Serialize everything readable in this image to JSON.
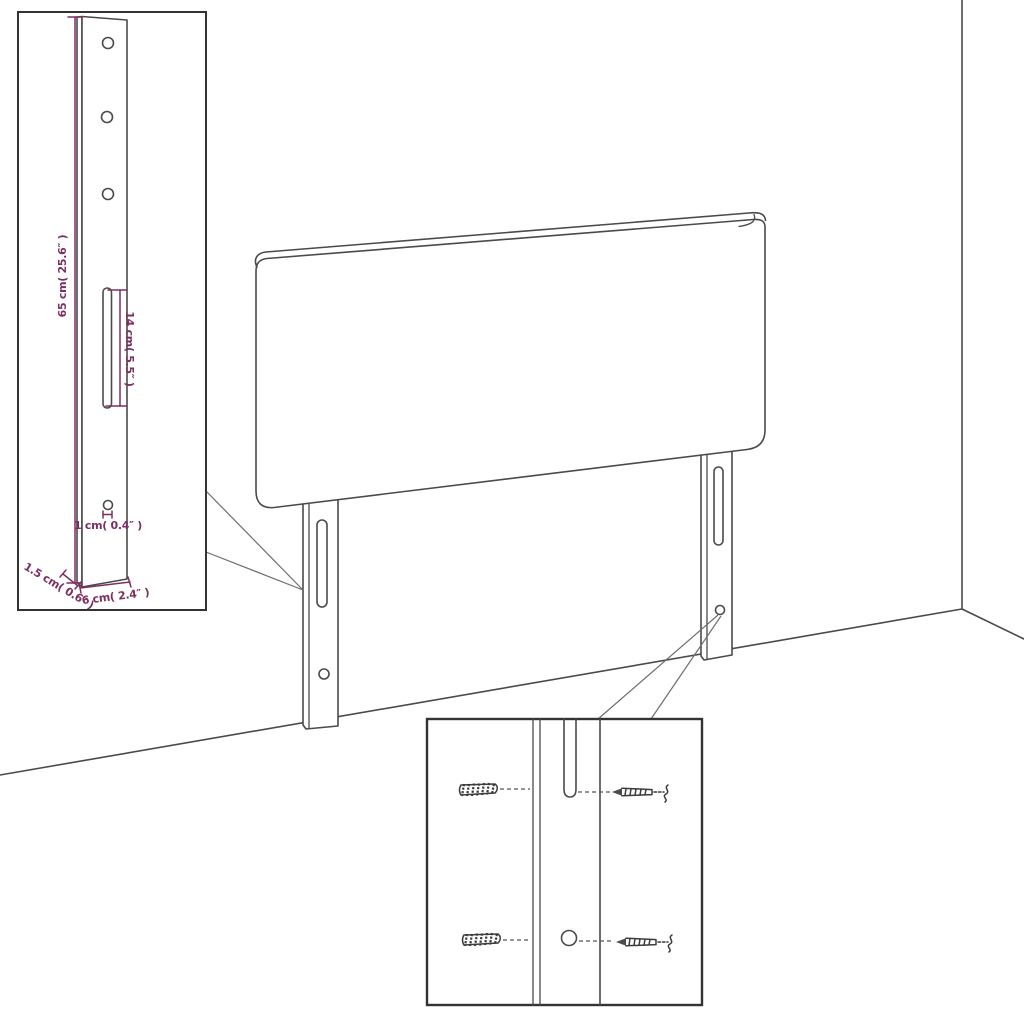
{
  "colors": {
    "background": "#ffffff",
    "drawing_line": "#4a4a4a",
    "inset_border": "#333333",
    "dimension_accent": "#7b2f62"
  },
  "inset_leg_detail": {
    "height_label": "65 cm( 25.6″ )",
    "slot_label": "14 cm( 5.5″ )",
    "hole_label": "1 cm( 0.4″ )",
    "depth_label": "1.5 cm( 0.6″ )",
    "width_label": "6 cm( 2.4″ )"
  }
}
